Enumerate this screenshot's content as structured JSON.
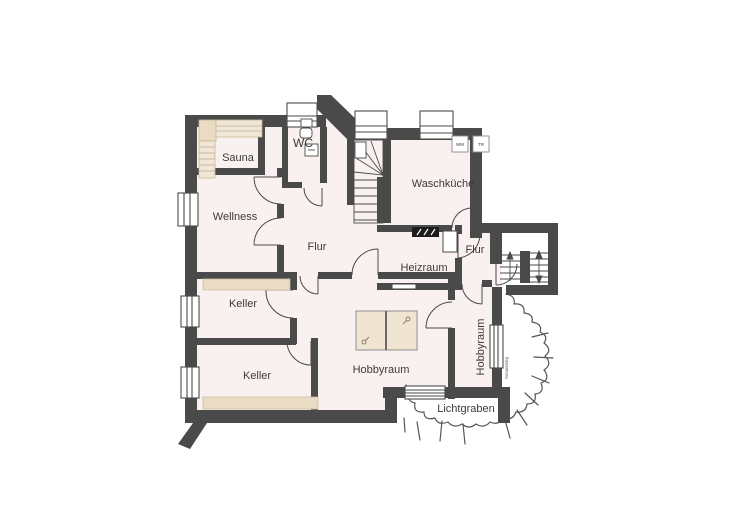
{
  "rooms": {
    "sauna": {
      "label": "Sauna"
    },
    "wellness": {
      "label": "Wellness"
    },
    "wc": {
      "label": "WC"
    },
    "waschkueche": {
      "label": "Waschküche"
    },
    "flur_mitte": {
      "label": "Flur"
    },
    "flur_rechts": {
      "label": "Flur"
    },
    "heizraum": {
      "label": "Heizraum"
    },
    "keller_1": {
      "label": "Keller"
    },
    "keller_2": {
      "label": "Keller"
    },
    "hobbyraum_1": {
      "label": "Hobbyraum"
    },
    "hobbyraum_2": {
      "label": "Hobbyraum"
    },
    "lichtgraben": {
      "label": "Lichtgraben"
    }
  },
  "appliances": {
    "washer_label": "WM",
    "dryer_label": "TR"
  },
  "annotations": {
    "exit_note": "Notausstieg"
  },
  "colors": {
    "wall": "#4a4a4a",
    "floor": "#f9f1ef",
    "white": "#ffffff",
    "furniture": "#e9dbc4",
    "furniture_light": "#f0e7d8",
    "furniture_edge": "#c8b794",
    "heater": "#1c1c1c",
    "line": "#4a4a4a",
    "terrain": "#555555"
  }
}
